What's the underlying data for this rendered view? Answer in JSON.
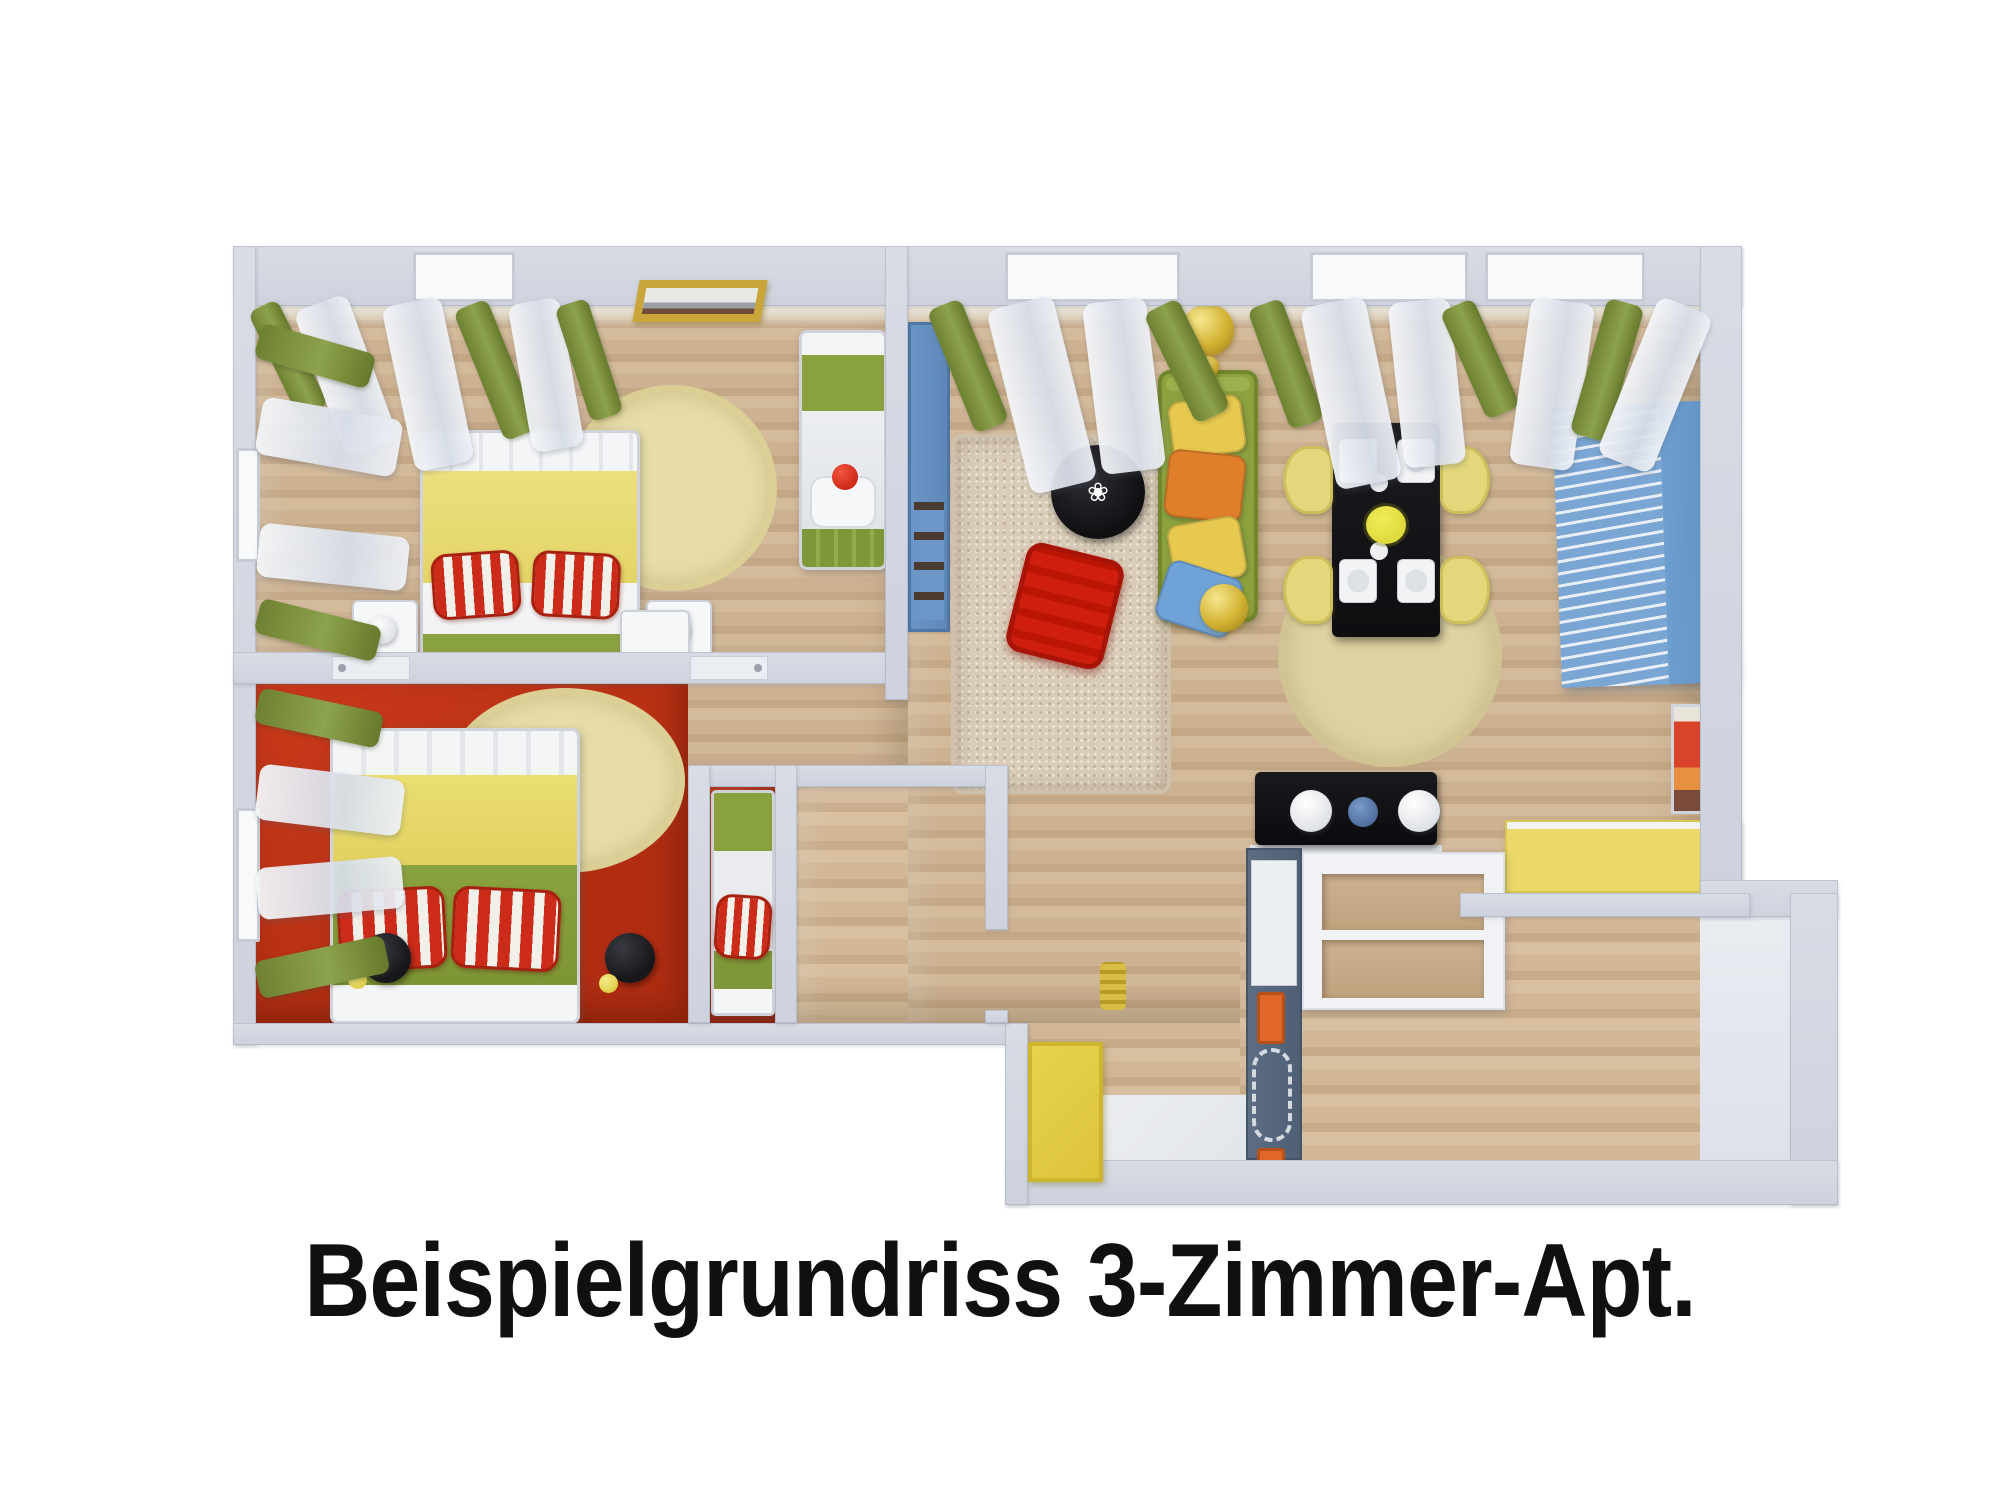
{
  "caption": {
    "text": "Beispielgrundriss 3-Zimmer-Apt."
  },
  "palette": {
    "background": "#ffffff",
    "wall": "#d8dce5",
    "wall_inner": "#edeae1",
    "wood": "#c9ad8b",
    "red_floor": "#c23517",
    "rug_beige": "#e7dda7",
    "rug_shag": "#d9cdb9",
    "sofa_green": "#8ca23f",
    "curtain_green": "#7d903f",
    "sheer_white": "#eef1f6",
    "pillow_yellow": "#e7c94f",
    "pillow_orange": "#df7f2a",
    "pillow_blue": "#6fa3d8",
    "stripe_red": "#c4271a",
    "bed_yellow": "#ecdf7d",
    "bed_green": "#8aa23e",
    "table_black": "#17171a",
    "pouf_red": "#cf1e0e",
    "chair_yellow": "#e4d77b",
    "cabinet_blue": "#6d9ed0",
    "counter_yellow": "#ead968",
    "kitchen_slate": "#5d6e84",
    "handle_orange": "#e2672a",
    "door_yellow": "#e8d34f",
    "lamp_gold": "#d9bd45",
    "caption": "#101010"
  }
}
